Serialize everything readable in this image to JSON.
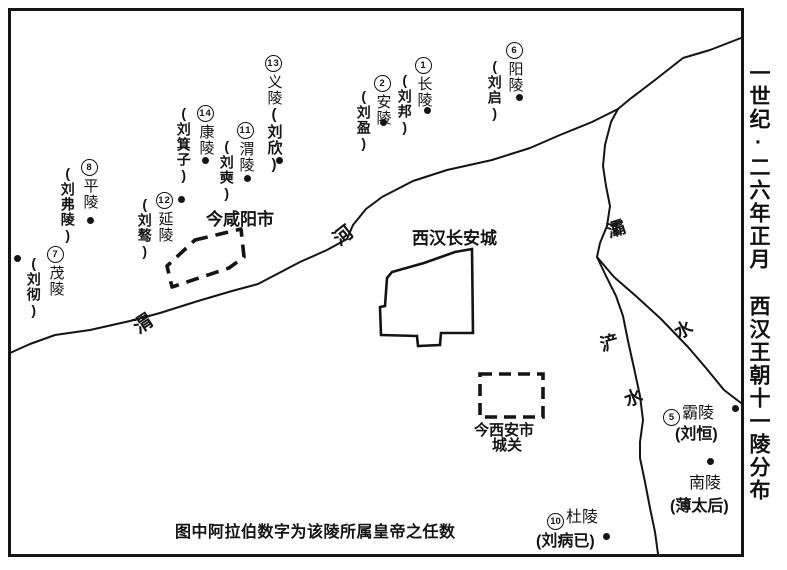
{
  "sidebar_title": {
    "line1": "一世纪·二六年正月",
    "line2": "西汉王朝十一陵分布"
  },
  "caption": "图中阿拉伯数字为该陵所属皇帝之任数",
  "places": {
    "changan_city": "西汉长安城",
    "xianyang_city": "今咸阳市",
    "xian_city_line1": "今西安市",
    "xian_city_line2": "城关"
  },
  "rivers": {
    "wei_char1": "渭",
    "wei_char2": "河",
    "ba_char1": "灞",
    "ba_char2": "水",
    "chan_char1": "浐",
    "chan_char2": "水"
  },
  "tombs": {
    "changling": {
      "num": "1",
      "name": "长陵",
      "emperor": "(刘邦)"
    },
    "anling": {
      "num": "2",
      "name": "安陵",
      "emperor": "(刘盈)"
    },
    "baling": {
      "num": "5",
      "name": "霸陵",
      "emperor": "(刘恒)"
    },
    "yangling": {
      "num": "6",
      "name": "阳陵",
      "emperor": "(刘启)"
    },
    "maoling": {
      "num": "7",
      "name": "茂陵",
      "emperor": "(刘彻)"
    },
    "pingling": {
      "num": "8",
      "name": "平陵",
      "emperor": "(刘弗陵)"
    },
    "duling": {
      "num": "10",
      "name": "杜陵",
      "emperor": "(刘病已)"
    },
    "weiling": {
      "num": "11",
      "name": "渭陵",
      "emperor": "(刘奭)"
    },
    "yanling": {
      "num": "12",
      "name": "延陵",
      "emperor": "(刘骜)"
    },
    "yiling": {
      "num": "13",
      "name": "义陵",
      "emperor": "(刘欣)"
    },
    "kangling": {
      "num": "14",
      "name": "康陵",
      "emperor": "(刘箕子)"
    },
    "nanling": {
      "name": "南陵",
      "emperor": "(薄太后)"
    }
  },
  "colors": {
    "ink": "#141414",
    "background": "#ffffff"
  }
}
